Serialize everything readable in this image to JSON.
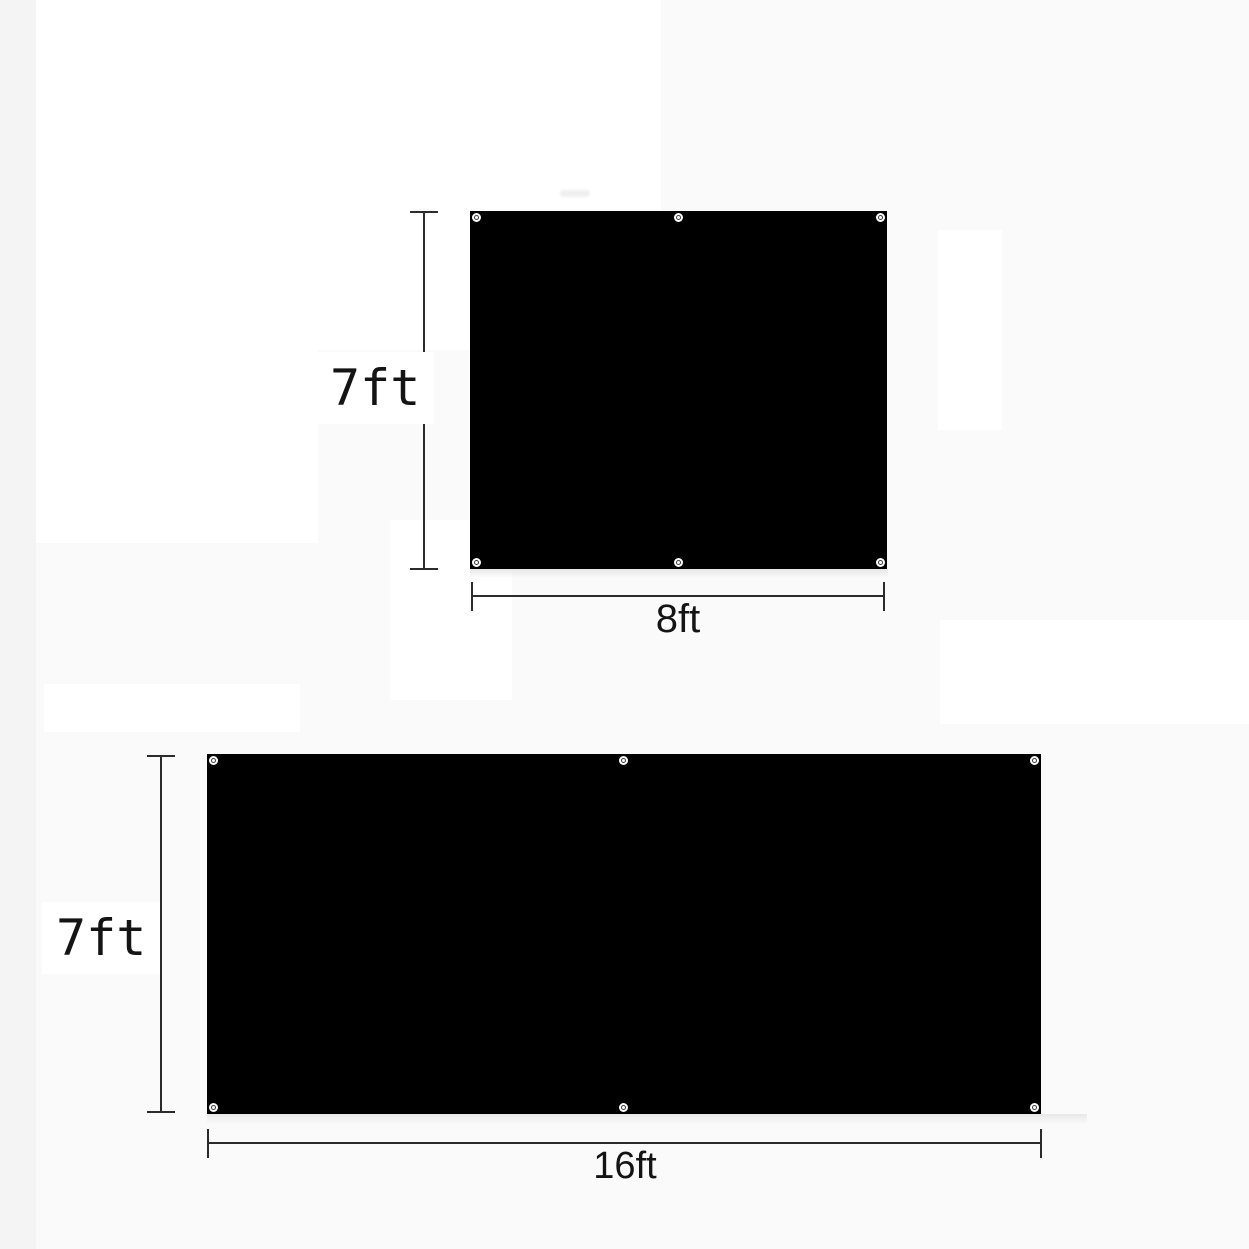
{
  "image": {
    "description": "Product dimension diagram: two black tarp/backdrop panels with corner and mid-edge grommets, annotated with height and width measurements",
    "background_color": "#fafafa",
    "panel_color": "#000000",
    "dimension_line_color": "#2b2b2b",
    "label_text_color": "#141414"
  },
  "diagrams": [
    {
      "id": "panel-7x8",
      "height_label": "7ft",
      "width_label": "8ft",
      "height_ft": 7,
      "width_ft": 8,
      "grommet_count": 6
    },
    {
      "id": "panel-7x16",
      "height_label": "7ft",
      "width_label": "16ft",
      "height_ft": 7,
      "width_ft": 16,
      "grommet_count": 6
    }
  ]
}
